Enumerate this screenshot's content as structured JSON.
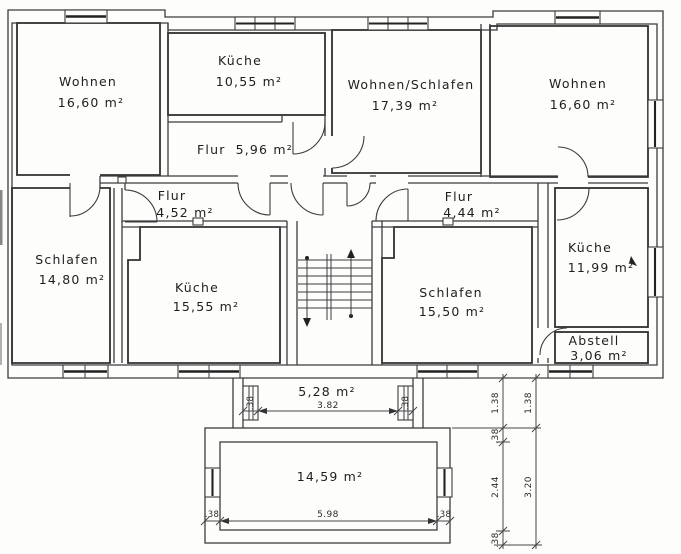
{
  "page": {
    "background": "#fdfdfc",
    "line_color": "#3c3c3c"
  },
  "rooms": [
    {
      "label": "Wohnen",
      "area": "16,60 m²"
    },
    {
      "label": "Küche",
      "area": "10,55 m²"
    },
    {
      "label": "Wohnen/Schlafen",
      "area": "17,39 m²"
    },
    {
      "label": "Wohnen",
      "area": "16,60 m²"
    },
    {
      "label": "Flur",
      "area": "5,96 m²"
    },
    {
      "label": "Flur",
      "area": "4,52 m²"
    },
    {
      "label": "Flur",
      "area": "4,44 m²"
    },
    {
      "label": "Schlafen",
      "area": "14,80 m²"
    },
    {
      "label": "Küche",
      "area": "15,55 m²"
    },
    {
      "label": "Schlafen",
      "area": "15,50 m²"
    },
    {
      "label": "Küche",
      "area": "11,99 m²"
    },
    {
      "label": "Abstell",
      "area": "3,06 m²"
    },
    {
      "label": "",
      "area": "5,28 m²"
    },
    {
      "label": "",
      "area": "14,59 m²"
    }
  ],
  "dimensions": {
    "vestibule_width": "3.82",
    "vestibule_pier_left": ".38",
    "vestibule_pier_right": ".38",
    "balcony_width": "5.98",
    "balcony_wall_left": ".38",
    "balcony_wall_right": ".38",
    "chain_outer": [
      "1.38",
      ".38",
      "2.44",
      ".38"
    ],
    "chain_inner": [
      "1.38",
      "3.20"
    ]
  }
}
